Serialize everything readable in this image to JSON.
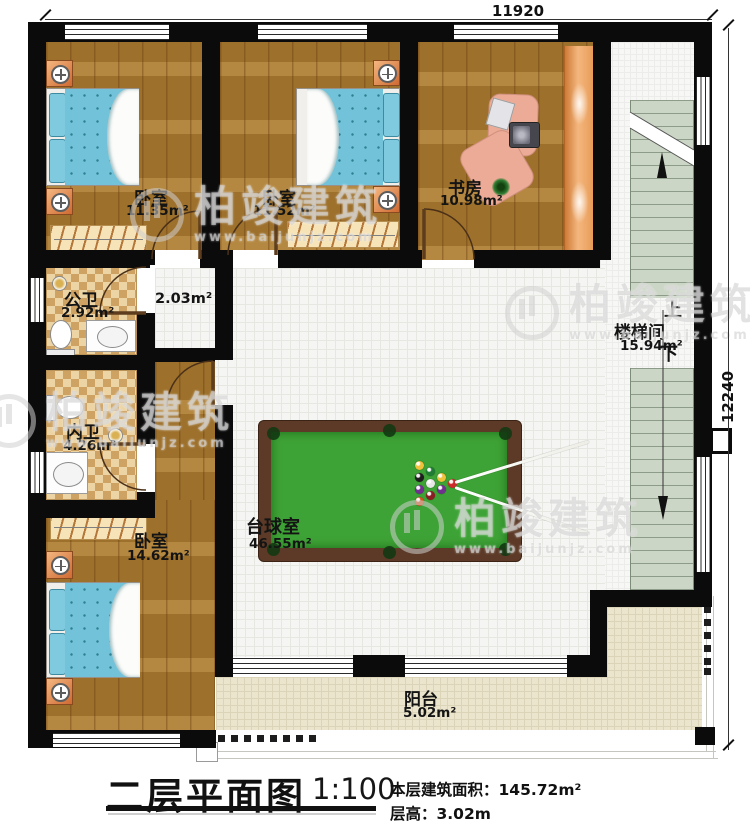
{
  "title_block": {
    "title": "二层平面图",
    "scale": "1:100",
    "building_area": "本层建筑面积：145.72m²",
    "floor_height": "层高：3.02m"
  },
  "dimensions": {
    "top": "11920",
    "right": "12240"
  },
  "rooms": [
    {
      "id": "bedroom-1",
      "name": "卧室",
      "area": "11.35m²"
    },
    {
      "id": "bedroom-2",
      "name": "卧室",
      "area": "11.52m²"
    },
    {
      "id": "study",
      "name": "书房",
      "area": "10.98m²"
    },
    {
      "id": "public-bath",
      "name": "公卫",
      "area": "2.92m²"
    },
    {
      "id": "inner-bath",
      "name": "内卫",
      "area": "4.26m²"
    },
    {
      "id": "bedroom-3",
      "name": "卧室",
      "area": "14.62m²"
    },
    {
      "id": "billiard-room",
      "name": "台球室",
      "area": "46.55m²"
    },
    {
      "id": "stairwell",
      "name": "楼梯间",
      "area": "15.94m²"
    },
    {
      "id": "balcony",
      "name": "阳台",
      "area": "5.02m²"
    }
  ],
  "hall": {
    "area": "2.03m²"
  },
  "stairs": {
    "up": "上",
    "down": "下"
  },
  "watermark": {
    "brand": "柏竣建筑",
    "url": "www.baijunjz.com"
  },
  "colors": {
    "wall": "#0b0b0b",
    "wood_floor": "#a87a31",
    "tile_floor": "#f5f5f3",
    "bath_checker_dark": "#cda263",
    "bath_checker_light": "#ecd4a5",
    "balcony_floor": "#ebe5cd",
    "stair_tread": "#ccd6c6",
    "pool_felt": "#3ea336",
    "pool_rim": "#5c3a27",
    "furniture_accent": "#e0884f",
    "bed_blue": "#72c3d9"
  }
}
